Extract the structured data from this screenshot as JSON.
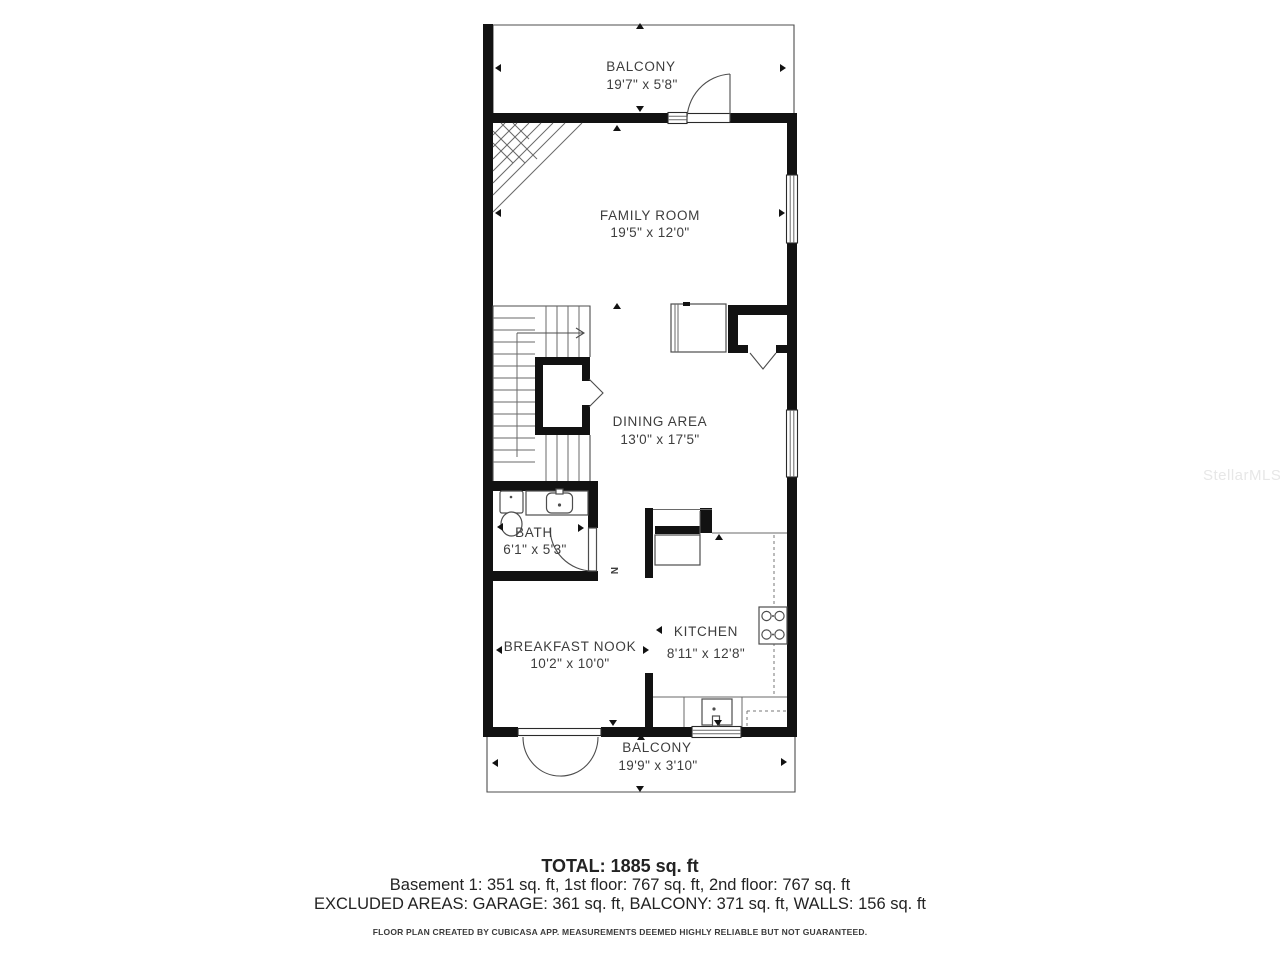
{
  "rooms": {
    "balcony_top": {
      "name": "BALCONY",
      "dims": "19'7\" x 5'8\""
    },
    "family_room": {
      "name": "FAMILY ROOM",
      "dims": "19'5\" x 12'0\""
    },
    "dining_area": {
      "name": "DINING AREA",
      "dims": "13'0\" x 17'5\""
    },
    "bath": {
      "name": "BATH",
      "dims": "6'1\" x 5'3\""
    },
    "breakfast_nook": {
      "name": "BREAKFAST NOOK",
      "dims": "10'2\" x 10'0\""
    },
    "kitchen": {
      "name": "KITCHEN",
      "dims": "8'11\" x 12'8\""
    },
    "balcony_bottom": {
      "name": "BALCONY",
      "dims": "19'9\" x 3'10\""
    }
  },
  "north_marker": "N",
  "summary": {
    "total": "TOTAL: 1885 sq. ft",
    "floors": "Basement 1: 351 sq. ft, 1st floor: 767 sq. ft, 2nd floor: 767 sq. ft",
    "excluded": "EXCLUDED AREAS: GARAGE: 361 sq. ft, BALCONY: 371 sq. ft, WALLS: 156 sq. ft",
    "disclaimer": "FLOOR PLAN CREATED BY CUBICASA APP. MEASUREMENTS DEEMED HIGHLY RELIABLE BUT NOT GUARANTEED."
  },
  "watermark": "StellarMLS",
  "colors": {
    "wall": "#121212",
    "line": "#4d4d4d",
    "text": "#3d3d3d",
    "watermark": "#e7e7e7"
  }
}
